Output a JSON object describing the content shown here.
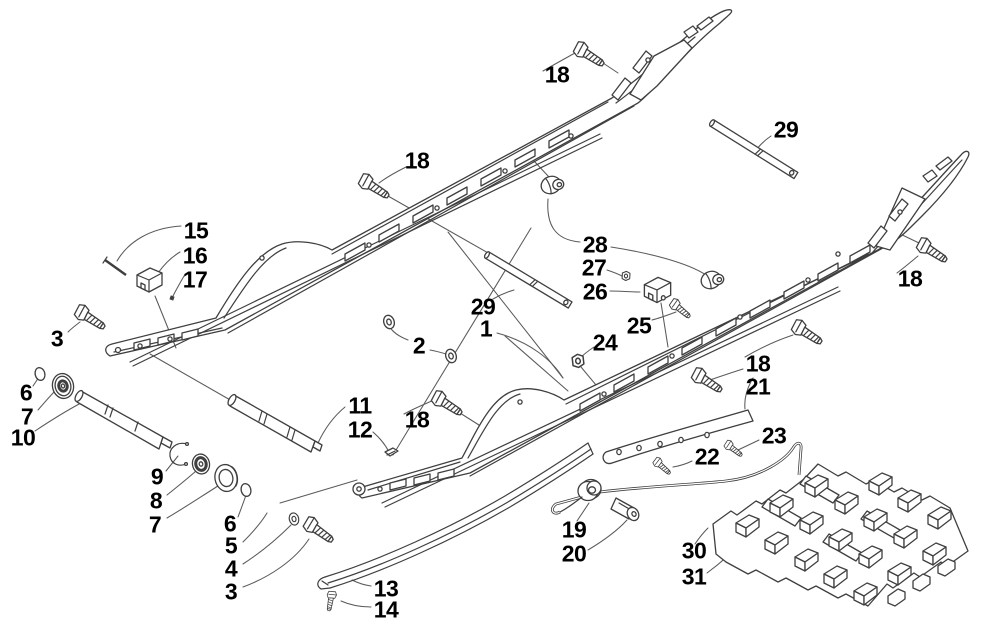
{
  "figure": {
    "type": "exploded-parts-diagram",
    "background": "#ffffff",
    "line_color": "#3f3f3f",
    "leader_color": "#5a5a5a",
    "label_color": "#000000",
    "label_font_size": 23,
    "callouts": [
      {
        "label": "15",
        "x": 196,
        "y": 231
      },
      {
        "label": "16",
        "x": 195,
        "y": 256
      },
      {
        "label": "17",
        "x": 195,
        "y": 280
      },
      {
        "label": "18",
        "x": 417,
        "y": 161
      },
      {
        "label": "18",
        "x": 557,
        "y": 75
      },
      {
        "label": "29",
        "x": 786,
        "y": 130
      },
      {
        "label": "18",
        "x": 910,
        "y": 279
      },
      {
        "label": "3",
        "x": 57,
        "y": 339
      },
      {
        "label": "6",
        "x": 26,
        "y": 393
      },
      {
        "label": "7",
        "x": 27,
        "y": 417
      },
      {
        "label": "10",
        "x": 23,
        "y": 438
      },
      {
        "label": "28",
        "x": 595,
        "y": 245
      },
      {
        "label": "27",
        "x": 594,
        "y": 268
      },
      {
        "label": "26",
        "x": 595,
        "y": 292
      },
      {
        "label": "29",
        "x": 483,
        "y": 307
      },
      {
        "label": "1",
        "x": 486,
        "y": 329
      },
      {
        "label": "2",
        "x": 419,
        "y": 346
      },
      {
        "label": "25",
        "x": 639,
        "y": 326
      },
      {
        "label": "24",
        "x": 605,
        "y": 343
      },
      {
        "label": "18",
        "x": 758,
        "y": 364
      },
      {
        "label": "21",
        "x": 758,
        "y": 387
      },
      {
        "label": "11",
        "x": 360,
        "y": 406
      },
      {
        "label": "12",
        "x": 360,
        "y": 430
      },
      {
        "label": "18",
        "x": 417,
        "y": 420
      },
      {
        "label": "23",
        "x": 774,
        "y": 436
      },
      {
        "label": "22",
        "x": 707,
        "y": 457
      },
      {
        "label": "9",
        "x": 157,
        "y": 477
      },
      {
        "label": "8",
        "x": 156,
        "y": 501
      },
      {
        "label": "7",
        "x": 155,
        "y": 525
      },
      {
        "label": "6",
        "x": 230,
        "y": 524
      },
      {
        "label": "5",
        "x": 231,
        "y": 546
      },
      {
        "label": "4",
        "x": 231,
        "y": 569
      },
      {
        "label": "3",
        "x": 231,
        "y": 592
      },
      {
        "label": "19",
        "x": 574,
        "y": 530
      },
      {
        "label": "20",
        "x": 574,
        "y": 554
      },
      {
        "label": "30",
        "x": 694,
        "y": 551
      },
      {
        "label": "31",
        "x": 694,
        "y": 577
      },
      {
        "label": "13",
        "x": 386,
        "y": 589
      },
      {
        "label": "14",
        "x": 386,
        "y": 610
      }
    ]
  }
}
